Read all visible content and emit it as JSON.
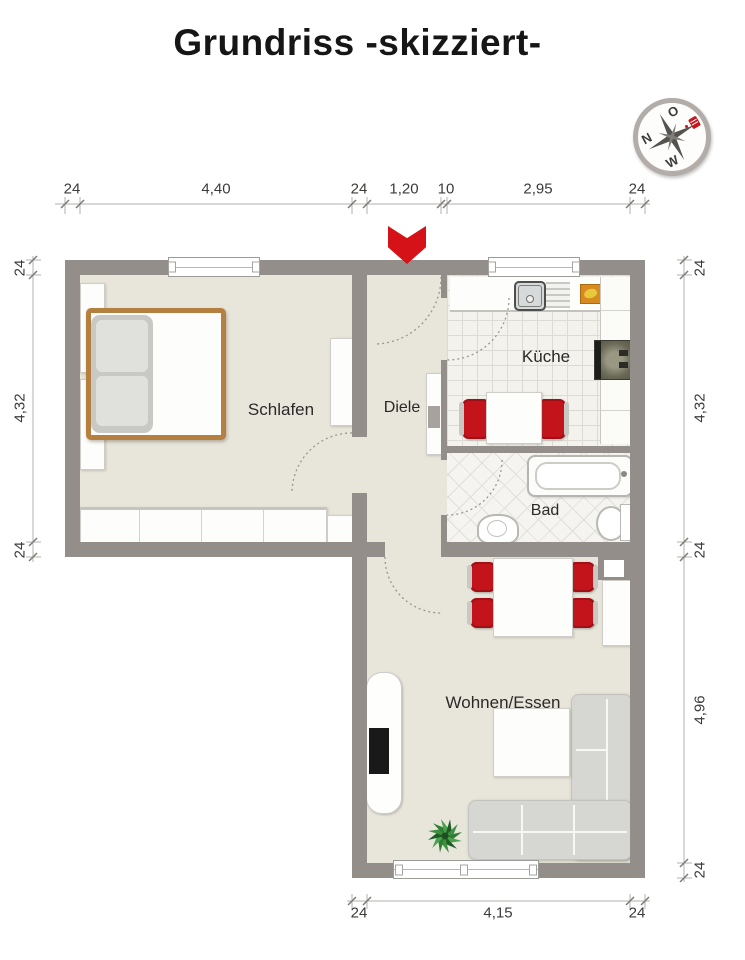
{
  "title": "Grundriss -skizziert-",
  "rooms": {
    "bedroom": "Schlafen",
    "hall": "Diele",
    "kitchen": "Küche",
    "bath": "Bad",
    "living": "Wohnen/Essen"
  },
  "dimensions": {
    "top": [
      "24",
      "4,40",
      "24",
      "1,20",
      "10",
      "2,95",
      "24"
    ],
    "left": [
      "24",
      "4,32",
      "24"
    ],
    "right": [
      "24",
      "4,32",
      "24",
      "4,96",
      "24"
    ],
    "bottom": [
      "24",
      "4,15",
      "24"
    ]
  },
  "compass": {
    "north": "N",
    "east": "O",
    "west": "W"
  },
  "colors": {
    "wall": "#948e8a",
    "floor": "#e8e5da",
    "accent_red": "#d41217",
    "chair_red": "#c3141c",
    "bed_frame_brown": "#b5803f",
    "sofa_gray": "#d6d7d2",
    "dimension_line": "#b4b2ad"
  },
  "icons": {
    "compass": "compass-icon",
    "entrance_arrow": "entrance-arrow-icon",
    "plant": "plant-icon",
    "kitchen_sink": "kitchen-sink-icon",
    "stove": "stove-icon",
    "bathtub": "bathtub-icon",
    "toilet": "toilet-icon",
    "washbasin": "washbasin-icon"
  }
}
